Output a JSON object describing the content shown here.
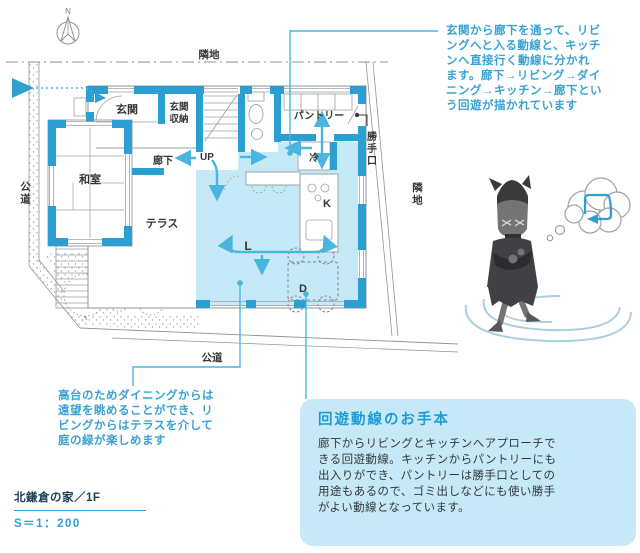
{
  "colors": {
    "accent_blue": "#2F9FD0",
    "wall_blue": "#2B9FD1",
    "ldk_fill": "#C6E9F7",
    "arrow_blue": "#4AB6E0",
    "callout_bg": "#C7E9F7",
    "callout_title": "#1E9BD5",
    "annotation_text": "#3AA2D3",
    "body_text": "#33383C",
    "footer_dark": "#1C4157",
    "plan_line_gray": "#8D959B"
  },
  "compass": {
    "label": "N"
  },
  "annotations": {
    "entrance_flow": {
      "lines": [
        "玄関から廊下を通って、リビ",
        "ングへと入る動線と、キッチ",
        "ンへ直接行く動線に分かれ",
        "ます。廊下→リビング→ダイ",
        "ニング→キッチン→廊下とい",
        "う回遊が描かれています"
      ]
    },
    "dining_view": {
      "lines": [
        "高台のためダイニングからは",
        "遠望を眺めることができ、リ",
        "ビングからはテラスを介して",
        "庭の緑が楽しめます"
      ]
    }
  },
  "callout": {
    "title": "回遊動線のお手本",
    "lines": [
      "廊下からリビングとキッチンへアプローチで",
      "きる回遊動線。キッチンからパントリーにも",
      "出入りができ、パントリーは勝手口としての",
      "用途もあるので、ゴミ出しなどにも使い勝手",
      "がよい動線となっています。"
    ]
  },
  "footer": {
    "project": "北鎌倉の家／1F",
    "scale": "S＝1：200"
  },
  "plan": {
    "labels": {
      "genkan": "玄関",
      "genkan_shuno_1": "玄関",
      "genkan_shuno_2": "収納",
      "up": "UP",
      "pantry": "パントリー",
      "katteguchi": "勝手口",
      "fridge": "冷",
      "rouka": "廊下",
      "washitsu": "和室",
      "terrace": "テラス",
      "kitchen": "K",
      "living": "L",
      "dining": "D",
      "road_left": "公道",
      "road_bottom": "公道",
      "neighbor_top": "隣地",
      "neighbor_right": "隣地"
    }
  },
  "character": {
    "name": "walking-cat-mascot",
    "thought_icon": "loop-arrow"
  }
}
